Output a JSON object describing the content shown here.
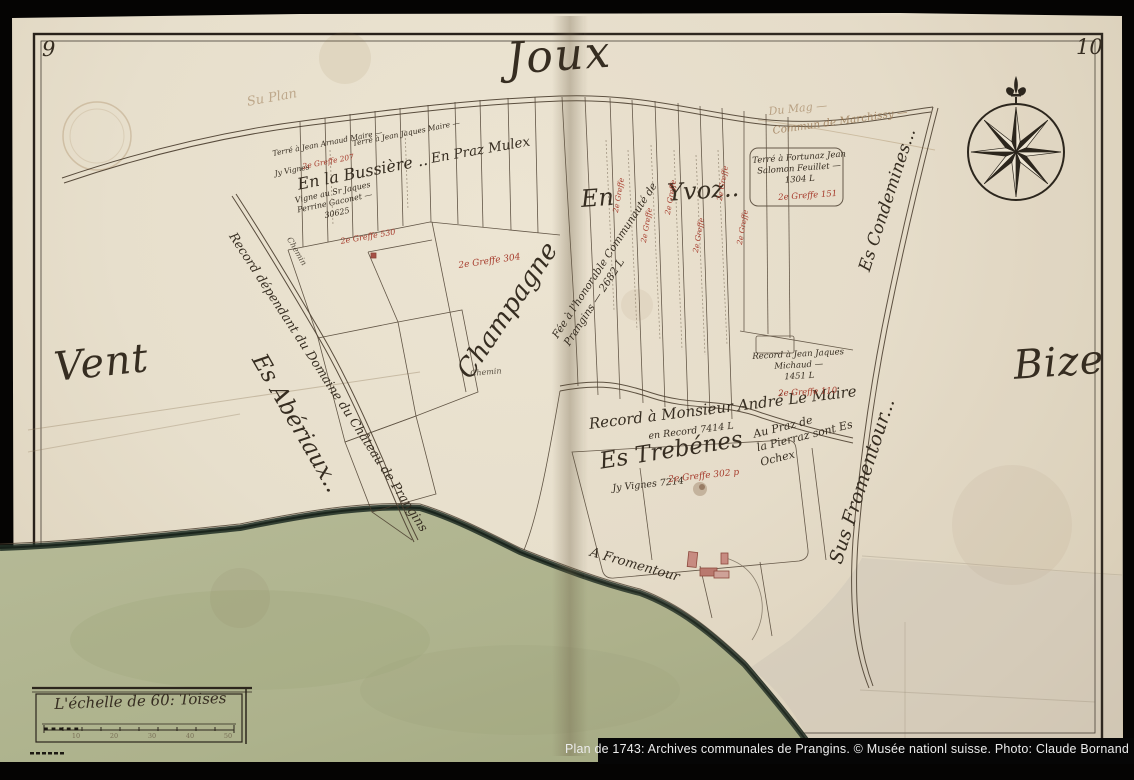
{
  "page_numbers": {
    "left": "9",
    "right": "10"
  },
  "cardinals": {
    "top": "Joux",
    "left": "Vent",
    "right": "Bize"
  },
  "places": {
    "bussiere": "En la Bussière ..",
    "praz_mulex": "En Praz Mulex",
    "yvoz": "En Yvoz..",
    "condemines": "Es Condemines...",
    "champagne": "Champagne",
    "trebenes": "Es Trebénes",
    "aberiaux": "Es Abériaux..",
    "sus_fromentour": "Sus Fromentour...",
    "a_fromentour": "A Fromentour",
    "praz_pierraz_1": "Au Praz de",
    "praz_pierraz_2": "la Pierraz sont Es",
    "praz_pierraz_3": "Ochex",
    "record_domaine": "Record dépendant du Domaine du Château de Prangins",
    "record_maire": "Record à Monsieur André Le Maire",
    "record_maire_sub": "en Record 7414 L",
    "marchissy": "Commun de Marchissy —",
    "du_mag": "Du Mag —",
    "su_plan": "Su Plan",
    "chemin": "Chemin"
  },
  "notes": {
    "feuillet_1": "Terré à Fortunaz Jean",
    "feuillet_2": "Salomon Feuillet —",
    "feuillet_3": "1304 L",
    "michaud_1": "Record à Jean Jaques",
    "michaud_2": "Michaud —",
    "michaud_3": "1451 L",
    "communaute_1": "Fée à l'honorable Communauté de",
    "communaute_2": "Prangins — 2682 L",
    "arnaud": "Terré à Jean Arnaud Maire —",
    "jaques": "Terré à Jean Jaques Maire —",
    "vigne_1": "Vigne au Sr Jaques",
    "vigne_2": "Perrine Gaconet —",
    "vigne_3": "30625",
    "jy_vignes": "Jy Vignes 7214",
    "jy_vigne_small": "Jy Vignes"
  },
  "red_notes": {
    "greffe": "2e Greffe",
    "g207": "2e Greffe 207",
    "g530": "2e Greffe 530",
    "g304": "2e Greffe 304",
    "g151": "2e Greffe 151",
    "g110": "2e Greffe 110",
    "g302": "2e Greffe 302 p"
  },
  "scale": {
    "label": "L'échelle de 60: Toises",
    "ticks": [
      "10",
      "20",
      "30",
      "40",
      "50"
    ]
  },
  "caption": "Plan de 1743: Archives communales de Prangins. © Musée nationl suisse. Photo: Claude Bornand",
  "colors": {
    "red_ink": "#a63b2c",
    "ink": "#3a3126",
    "paper": "#e8dfcc",
    "lake": "#b2b794"
  }
}
